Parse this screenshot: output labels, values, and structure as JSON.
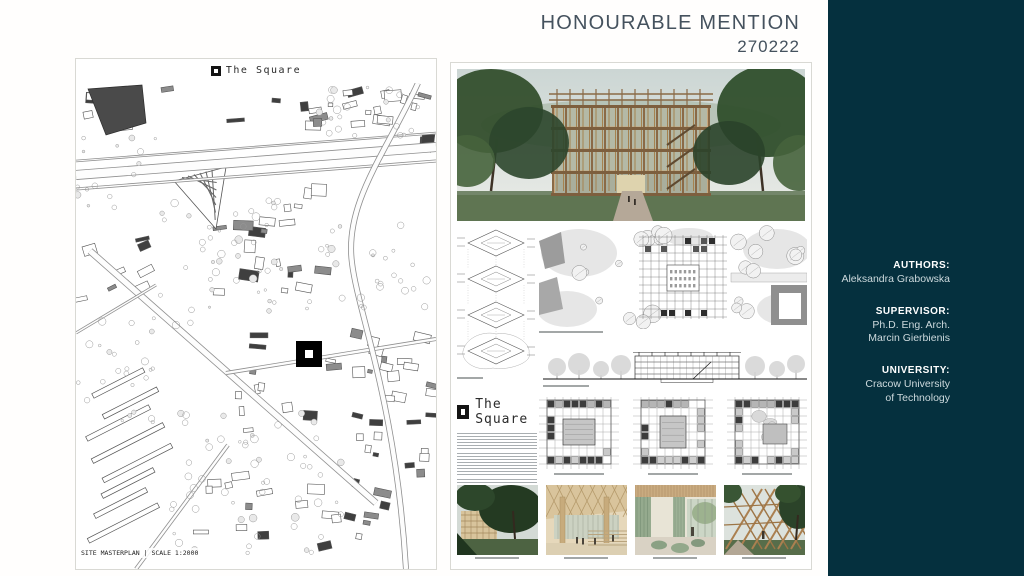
{
  "header": {
    "title": "HONOURABLE MENTION",
    "entry_number": "270222"
  },
  "sidebar": {
    "credits": [
      {
        "label": "AUTHORS:",
        "value": "Aleksandra Grabowska"
      },
      {
        "label": "SUPERVISOR:",
        "value": "Ph.D. Eng. Arch.\nMarcin Gierbienis"
      },
      {
        "label": "UNIVERSITY:",
        "value": "Cracow University\nof Technology"
      }
    ]
  },
  "boards": {
    "left": {
      "logo_text": "The Square",
      "caption": "SITE MASTERPLAN | SCALE 1:2000"
    },
    "right": {
      "logo_text": "The Square"
    }
  },
  "colors": {
    "sidebar_bg": "#05303e",
    "title_text": "#45525e",
    "site_marker": "#000000"
  }
}
